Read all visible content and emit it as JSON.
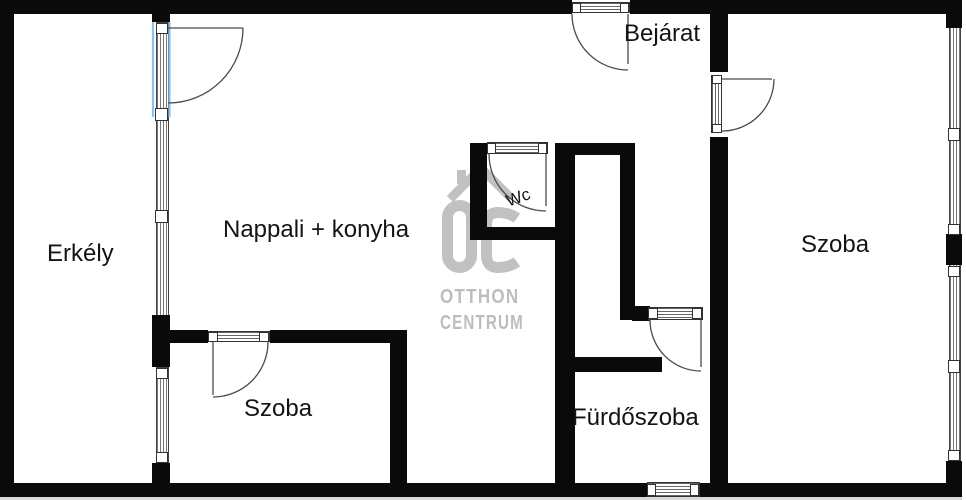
{
  "floorplan": {
    "rooms": [
      {
        "id": "erkely",
        "label": "Erkély"
      },
      {
        "id": "nappali",
        "label": "Nappali + konyha"
      },
      {
        "id": "bejarat",
        "label": "Bejárat"
      },
      {
        "id": "wc",
        "label": "Wc"
      },
      {
        "id": "szoba-bottom",
        "label": "Szoba"
      },
      {
        "id": "furdoszoba",
        "label": "Fürdőszoba"
      },
      {
        "id": "szoba-right",
        "label": "Szoba"
      }
    ],
    "watermark": {
      "monogram": "OC",
      "line1": "OTTHON",
      "line2": "CENTRUM"
    },
    "colors": {
      "wall": "#0a0a0a",
      "watermark_gray": "#c1c1c1",
      "door_highlight_blue": "#8fc0ea",
      "door_arc": "#4a4a4a"
    }
  }
}
